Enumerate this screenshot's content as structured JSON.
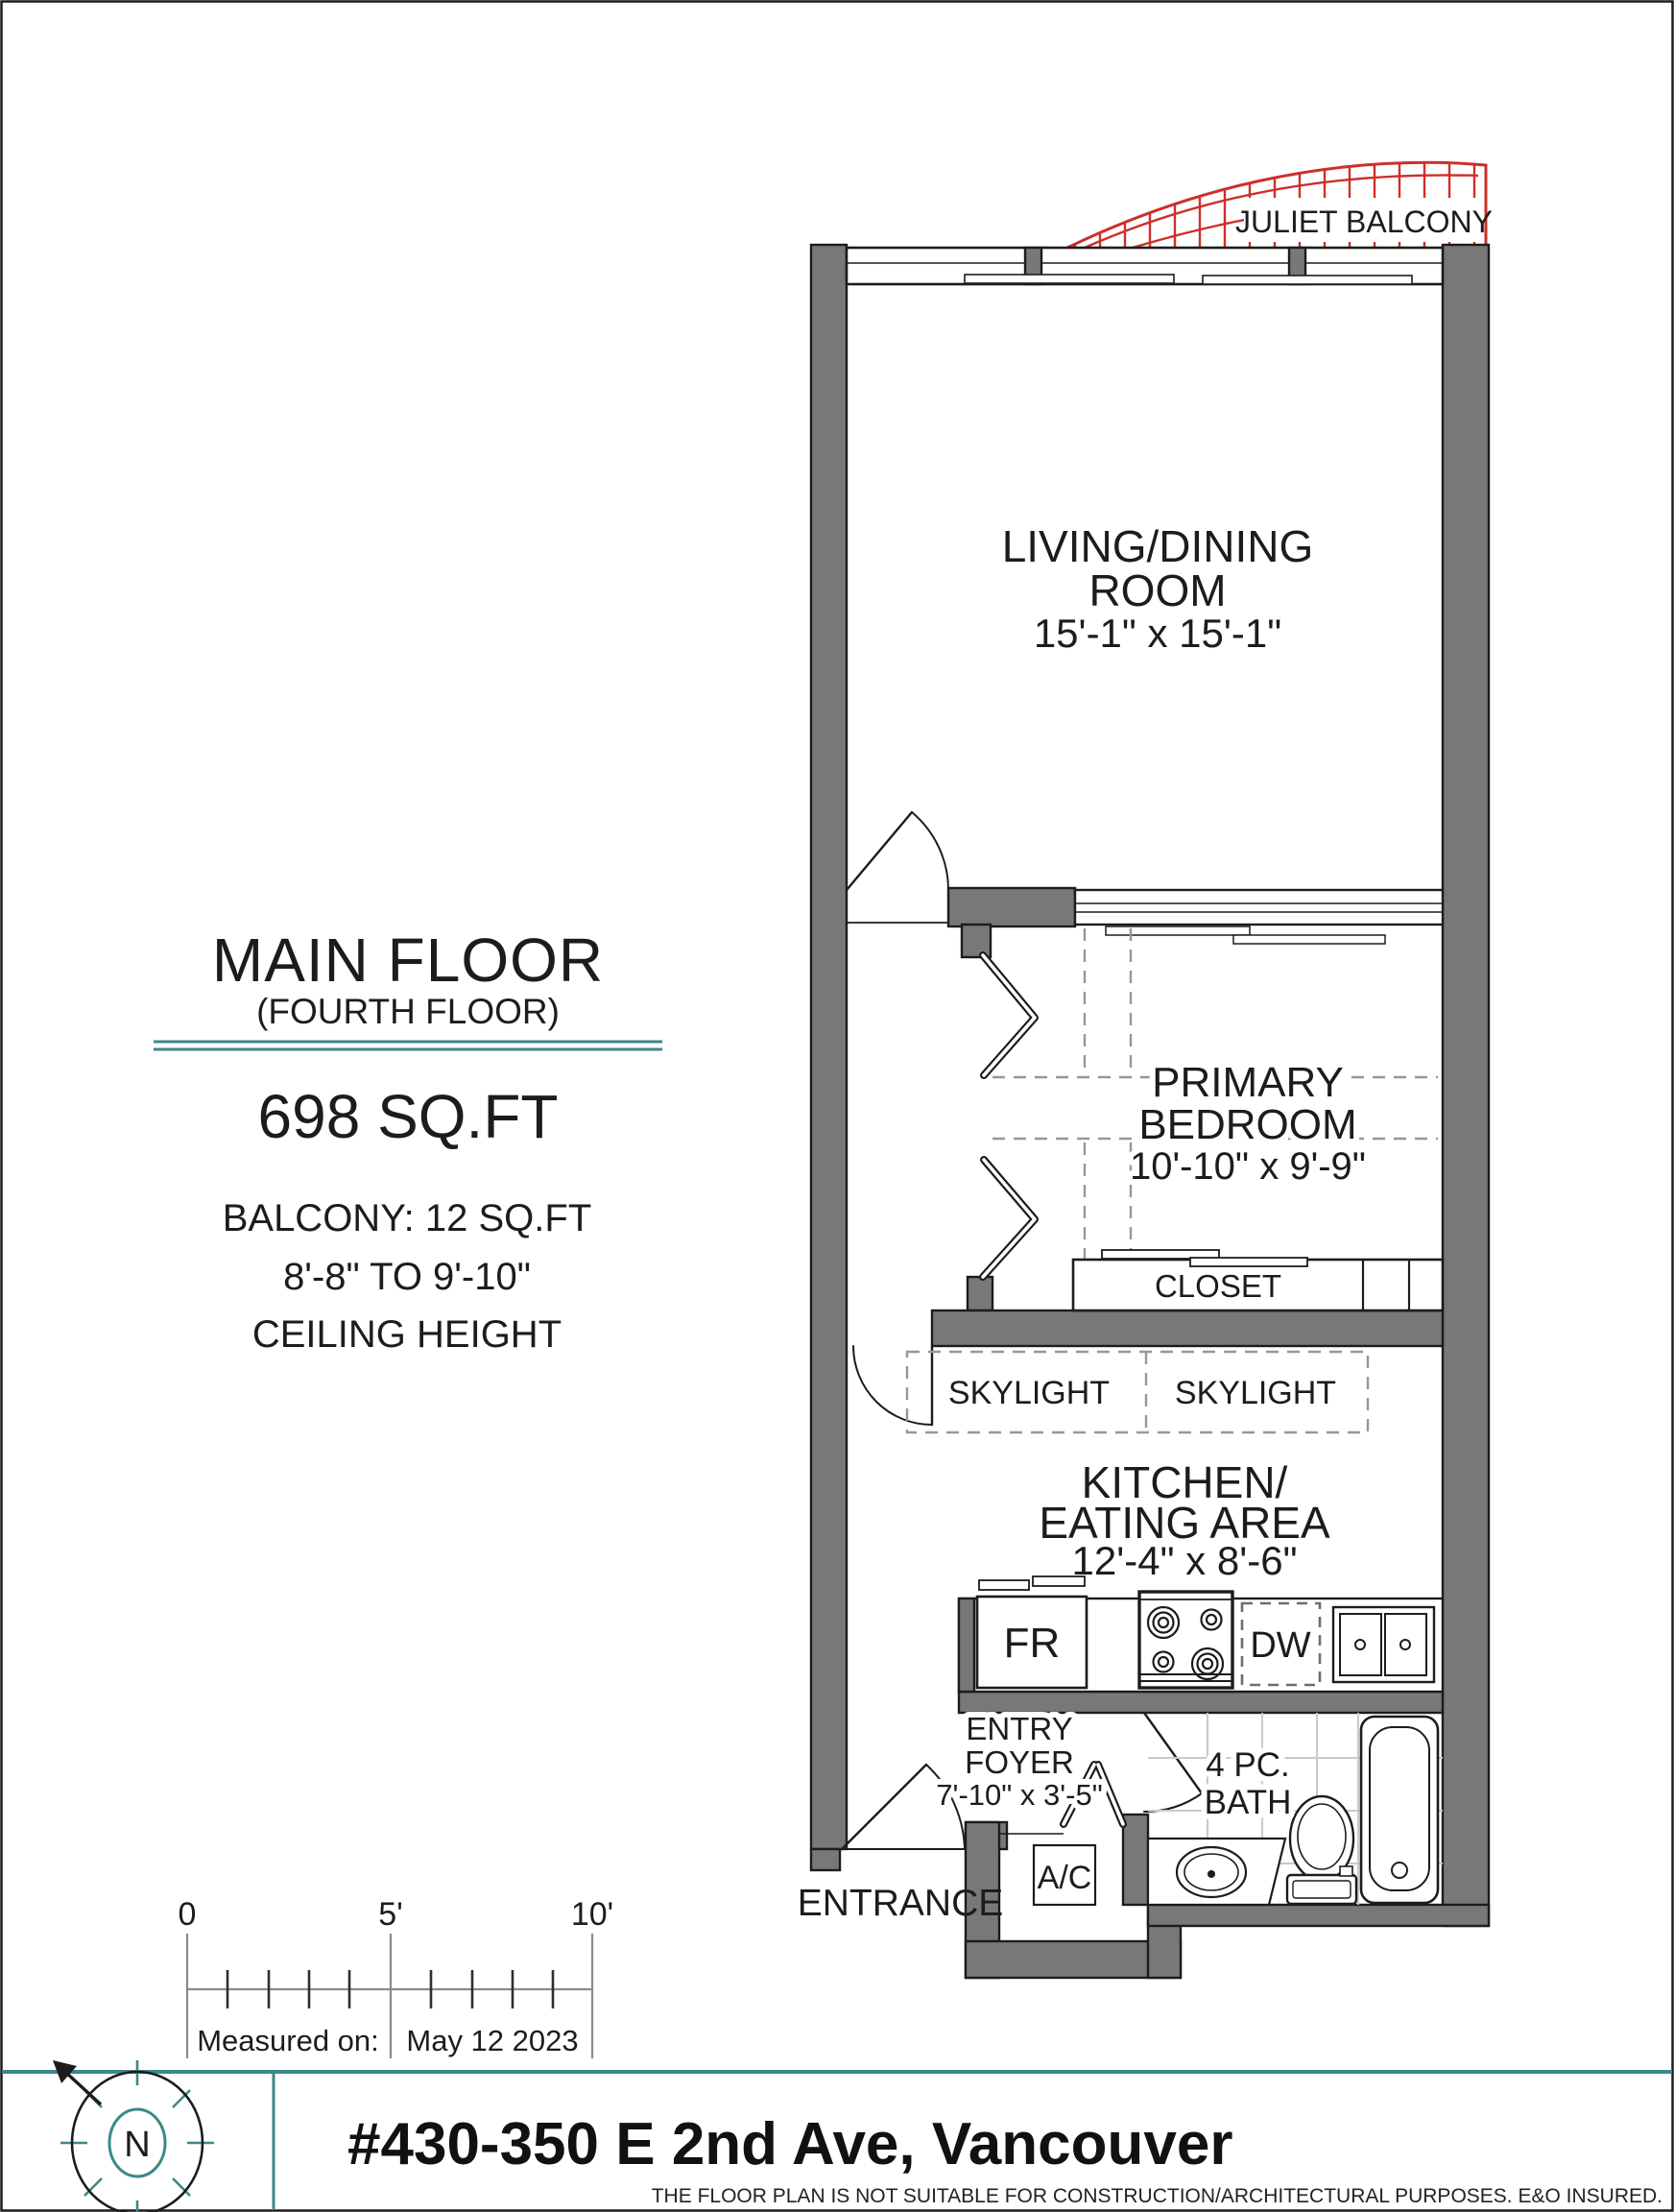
{
  "title_block": {
    "floor_title": "MAIN FLOOR",
    "floor_subtitle": "(FOURTH FLOOR)",
    "area": "698 SQ.FT",
    "balcony_area": "BALCONY:  12 SQ.FT",
    "ceiling_range": "8'-8\"  TO 9'-10\"",
    "ceiling_label": "CEILING HEIGHT"
  },
  "plan": {
    "juliet_balcony": "JULIET BALCONY",
    "living": {
      "line1": "LIVING/DINING",
      "line2": "ROOM",
      "dims": "15'-1\" x 15'-1\""
    },
    "bedroom": {
      "line1": "PRIMARY",
      "line2": "BEDROOM",
      "dims": "10'-10\" x 9'-9\""
    },
    "closet": "CLOSET",
    "skylight_left": "SKYLIGHT",
    "skylight_right": "SKYLIGHT",
    "kitchen": {
      "line1": "KITCHEN/",
      "line2": "EATING AREA",
      "dims": "12'-4\" x 8'-6\""
    },
    "entry": {
      "line1": "ENTRY",
      "line2": "FOYER",
      "dims": "7'-10\" x 3'-5\""
    },
    "bath": {
      "line1": "4 PC.",
      "line2": "BATH"
    },
    "entrance": "ENTRANCE",
    "ac_unit": "A/C",
    "fridge": "FR",
    "dishwasher": "DW"
  },
  "scale_bar": {
    "tick0": "0",
    "tick5": "5'",
    "tick10": "10'",
    "measured_label": "Measured on:",
    "measured_date": "May 12  2023"
  },
  "footer": {
    "address": "#430-350 E 2nd Ave, Vancouver",
    "north_letter": "N",
    "disclaimer": "THE  FLOOR PLAN  IS NOT SUITABLE FOR CONSTRUCTION/ARCHITECTURAL PURPOSES.    E&O INSURED."
  },
  "colors": {
    "wall": "#787878",
    "line": "#1c1c1c",
    "teal": "#3d8888",
    "red": "#cd2f2a",
    "dash": "#979797",
    "tile": "#c7cacb",
    "scale": "#8a8a8a"
  }
}
